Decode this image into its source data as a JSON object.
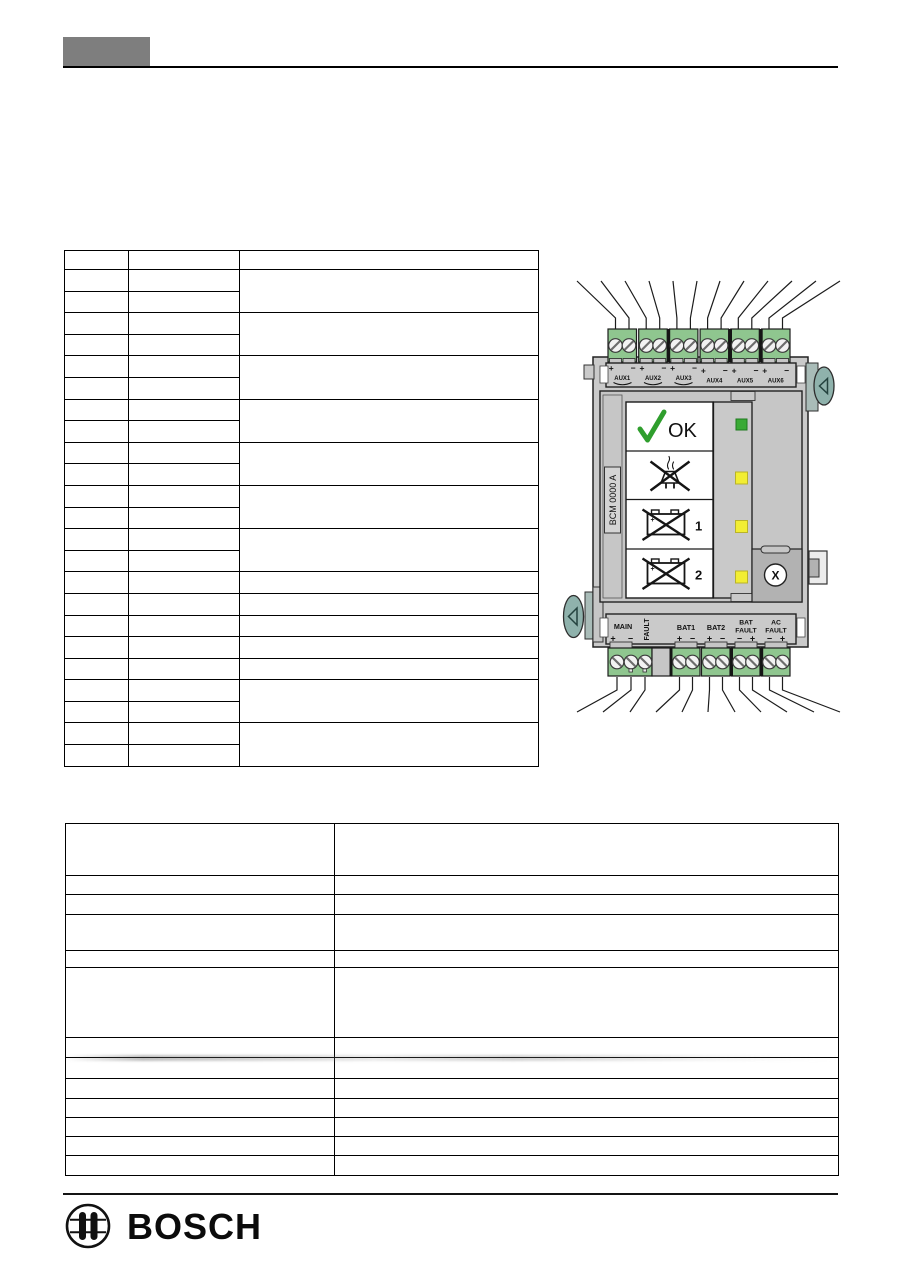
{
  "device": {
    "model": "BCM 0000 A",
    "top_terminals": [
      {
        "label": "AUX1",
        "left": "+",
        "right": "−"
      },
      {
        "label": "AUX2",
        "left": "+",
        "right": "−"
      },
      {
        "label": "AUX3",
        "left": "+",
        "right": "−"
      },
      {
        "label": "AUX4",
        "left": "+",
        "right": "−"
      },
      {
        "label": "AUX5",
        "left": "+",
        "right": "−"
      },
      {
        "label": "AUX6",
        "left": "+",
        "right": "−"
      }
    ],
    "bottom_terminals": {
      "main": {
        "label": "MAIN",
        "left": "+",
        "right": "−"
      },
      "fault": {
        "label": "FAULT"
      },
      "bat1": {
        "label": "BAT1",
        "left": "+",
        "right": "−"
      },
      "bat2": {
        "label": "BAT2",
        "left": "+",
        "right": "−"
      },
      "bat_fault": {
        "line1": "BAT",
        "line2": "FAULT",
        "left": "−",
        "right": "+"
      },
      "ac_fault": {
        "line1": "AC",
        "line2": "FAULT",
        "left": "−",
        "right": "+"
      }
    },
    "status_panel": {
      "ok_label": "OK",
      "battery1_label": "1",
      "battery2_label": "2"
    },
    "reset_button_label": "X",
    "leds": [
      {
        "name": "ok-led",
        "color": "#3aaa35"
      },
      {
        "name": "mains-fault-led",
        "color": "#f2ee33"
      },
      {
        "name": "battery1-fault-led",
        "color": "#f2ee33"
      },
      {
        "name": "battery2-fault-led",
        "color": "#f2ee33"
      }
    ]
  },
  "tables": {
    "upper_left_table": {
      "columns": 3,
      "data_rows": 23,
      "all_cells_blank": true
    },
    "lower_table": {
      "columns": 2,
      "rows": 13,
      "all_cells_blank": true
    }
  },
  "footer": {
    "brand": "BOSCH"
  },
  "palette": {
    "device_body": "#cacaca",
    "terminal_green": "#8fc68f",
    "led_green": "#3aaa35",
    "led_yellow": "#f2ee33",
    "screw_teal": "#8fb2ac",
    "dark_panel": "#b2b2b2",
    "header_block": "#7e7e7e",
    "check_green": "#2f9e2d"
  }
}
